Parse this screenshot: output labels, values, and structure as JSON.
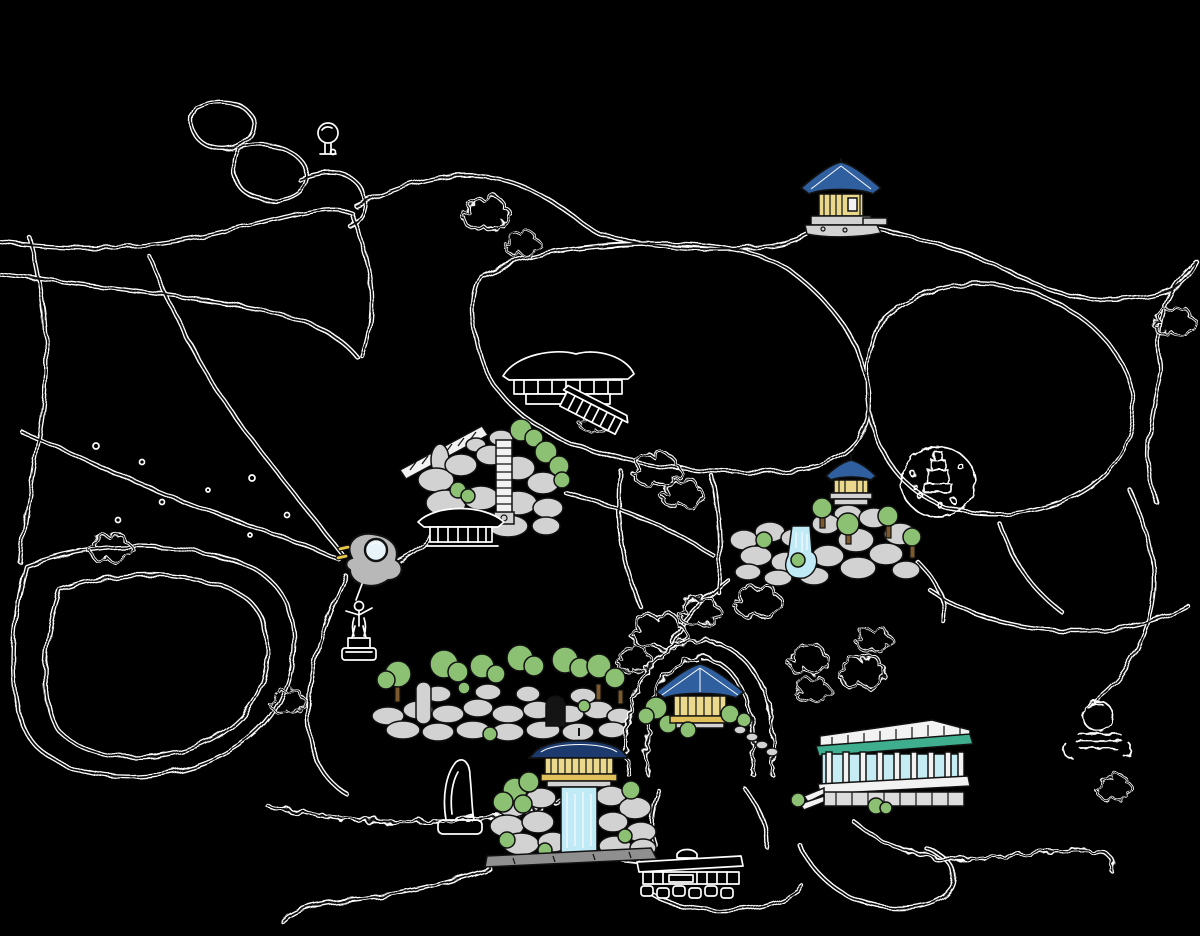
{
  "canvas": {
    "width": 1200,
    "height": 936,
    "background": "#000000"
  },
  "palette": {
    "bg": "#000000",
    "ink": "#111111",
    "paper": "#ffffff",
    "rock": "#d2d2d2",
    "foliage": "#8cc173",
    "trunk": "#7d5a2e",
    "water": "#c0eaf6",
    "roofBlue": "#2f5f9e",
    "roofNavy": "#1d3a6e",
    "wallCream": "#ead98c",
    "bandGold": "#dfc05a",
    "stoneBase": "#8f8f8f",
    "teal": "#3fae8f",
    "glass": "#c5ecf2",
    "whiteStruct": "#f2f2f2",
    "lowerGray": "#dcdcdc",
    "caveDark": "#141414",
    "lensBlue": "#e8f4fa",
    "sculptureGray": "#b8b8b8",
    "markerYellow": "#e8c84a"
  },
  "map": {
    "style": "hand-drawn park map, black line-work with white casing on dark background",
    "landmarks": [
      {
        "name": "hilltop-pavilion",
        "x": 797,
        "y": 158
      },
      {
        "name": "hanok-sketch-upper",
        "x": 498,
        "y": 338
      },
      {
        "name": "garden-slide-rockery",
        "x": 406,
        "y": 408
      },
      {
        "name": "hanok-sketch-lower",
        "x": 418,
        "y": 500
      },
      {
        "name": "spring-rockery",
        "x": 728,
        "y": 452
      },
      {
        "name": "monument-enclosure",
        "x": 900,
        "y": 442
      },
      {
        "name": "sculpture-lens",
        "x": 340,
        "y": 530
      },
      {
        "name": "statue",
        "x": 334,
        "y": 594
      },
      {
        "name": "rock-wall-cave",
        "x": 368,
        "y": 644
      },
      {
        "name": "stone-loop",
        "x": 700,
        "y": 704
      },
      {
        "name": "octagon-pavilion",
        "x": 700,
        "y": 700
      },
      {
        "name": "waterfall-pagoda",
        "x": 483,
        "y": 728
      },
      {
        "name": "conservatory",
        "x": 812,
        "y": 718
      },
      {
        "name": "stone-obelisk",
        "x": 436,
        "y": 756
      },
      {
        "name": "sphere-monument",
        "x": 1062,
        "y": 686
      },
      {
        "name": "entrance-gate",
        "x": 633,
        "y": 848
      },
      {
        "name": "small-tree",
        "x": 314,
        "y": 120
      }
    ]
  }
}
